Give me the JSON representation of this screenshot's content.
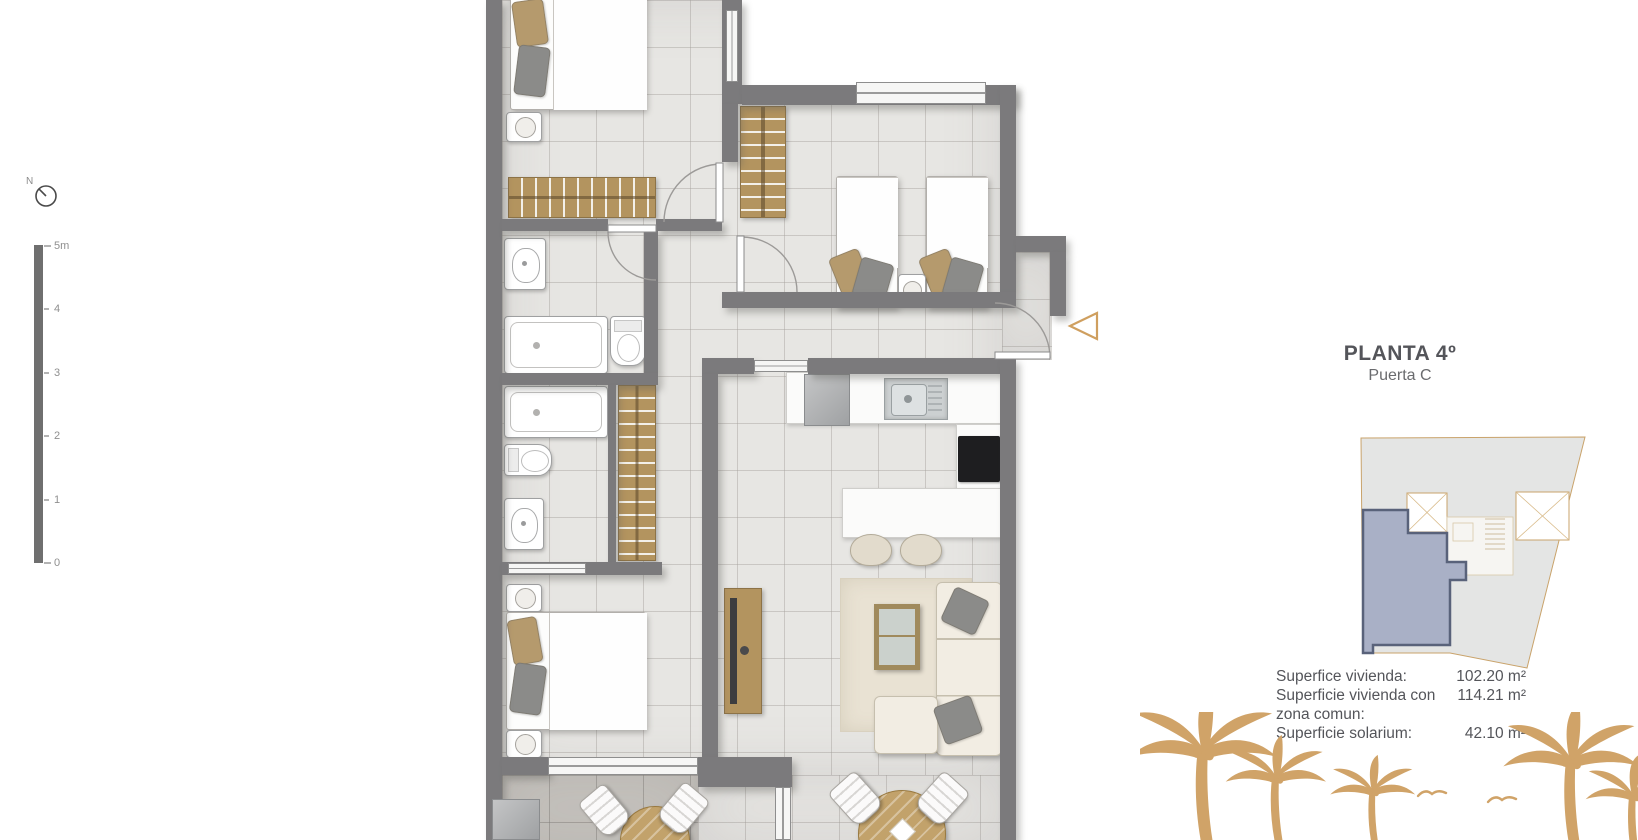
{
  "north": {
    "label": "N"
  },
  "scale_bar": {
    "labels": [
      "5m",
      "4",
      "3",
      "2",
      "1",
      "0"
    ]
  },
  "panel": {
    "title": "PLANTA 4º",
    "subtitle": "Puerta C",
    "areas": [
      {
        "label": "Superfice vivienda:",
        "value": "102.20 m²"
      },
      {
        "label": "Superficie vivienda con zona comun:",
        "value": "114.21 m²"
      },
      {
        "label": "Superficie solarium:",
        "value": "42.10 m²"
      }
    ]
  },
  "colors": {
    "wall": "#7b7a7c",
    "wood": "#b3945f",
    "accent_gold": "#d0a368",
    "unit_highlight": "#a9b0c6",
    "text": "#54555a"
  }
}
